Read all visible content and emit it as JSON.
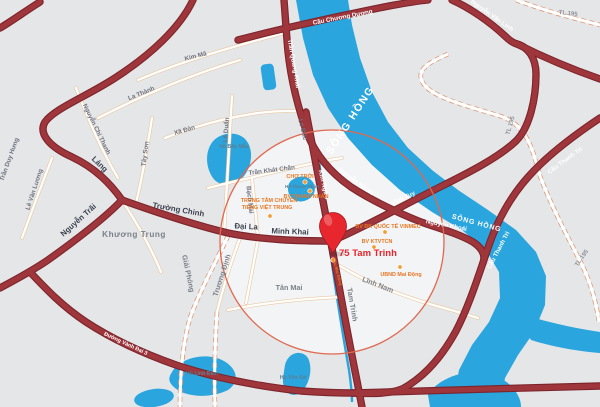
{
  "marker": {
    "label": "75 Tam Trinh"
  },
  "labels": {
    "kim_ma": "Kim Mã",
    "la_thanh": "La Thành",
    "nguyen_chi_thanh": "Nguyễn Chí Thanh",
    "tran_duy_hung": "Trần Duy Hưng",
    "le_van_luong": "Lê Văn Lương",
    "tay_son": "Tây Sơn",
    "xa_dan": "Xã Đàn",
    "le_duan": "Lê Duẩn",
    "lo_duc": "Lò Đúc",
    "bach_mai": "Bạch Mai",
    "tran_khat_chan": "Trần Khát Chân",
    "giai_phong": "Giải Phóng",
    "truong_dinh": "Trương Định",
    "tan_mai": "Tân Mai",
    "linh_nam": "Lĩnh Nam",
    "tam_trinh": "Tam Trinh",
    "khuong_trung": "Khương Trung",
    "lang": "Láng",
    "truong_chinh": "Trường Chinh",
    "nguyen_trai": "Nguyễn Trãi",
    "dai_la": "Đại La",
    "minh_khai": "Minh Khai",
    "cau_chuong_duong": "Cầu Chương Dương",
    "tran_quang_khai": "Trần Quang Khải",
    "nguyen_khoai": "Nguyễn Khoái",
    "vinh_tuy": "Vĩnh Tuy",
    "kim_nguu": "Kim Ngưu",
    "cau_thanh_tri": "Cầu Thanh Trì",
    "nguyen_van_linh": "Nguyễn Văn Linh",
    "vanh_dai_3": "Đường Vành Đai 3",
    "tl_195": "TL 195",
    "song_hong": "SÔNG HỒNG",
    "ho_bay_mau": "Hồ Bảy Mẫu",
    "ho_thanh_nhan": "Hồ Thanh Nhàn",
    "ho_linh_dam": "Hồ Linh Đàm",
    "ho_yen_so": "Hồ Yên Sở",
    "cho_troi": "CHỢ TRỜI",
    "bv_thanh_nhan": "BV THANH NHÀN",
    "trung_tam_1": "TRUNG TÂM CHUYÊN",
    "trung_tam_2": "TIẾNG VIỆT TRUNG",
    "bv_vinmec": "BV ĐK QUỐC TẾ VINMEC",
    "bv_ktvtcn": "BV KTVTCN",
    "cau_mai_dong": "Cầu Mai Động",
    "ubnd_mai_dong": "UBND Mai Động"
  },
  "colors": {
    "background": "#e5e6e8",
    "water": "#2aa5dd",
    "road_major": "#9e363c",
    "road_major_casing": "#7c242b",
    "road_minor_casing": "#e9c9a2",
    "poi_orange": "#e87722",
    "marker_red": "#e8242c",
    "highlight_circle_border": "#e0684f"
  }
}
